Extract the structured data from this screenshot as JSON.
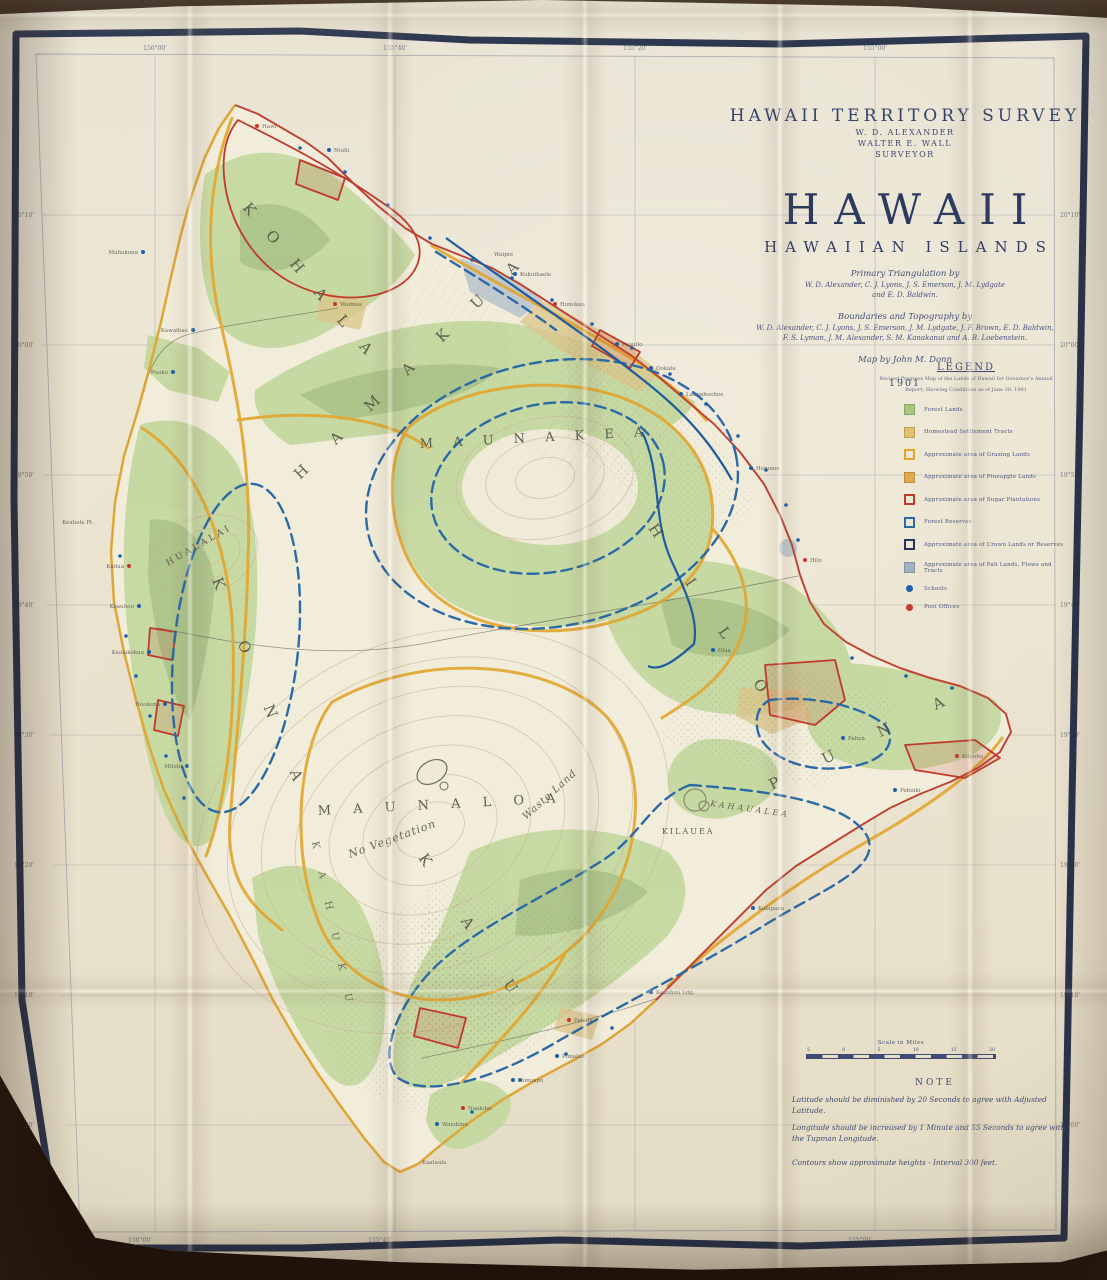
{
  "header": {
    "survey_title": "HAWAII TERRITORY SURVEY",
    "official_1": "W. D. ALEXANDER",
    "official_2": "WALTER E. WALL",
    "official_3": "SURVEYOR",
    "main_title": "HAWAII",
    "subtitle": "HAWAIIAN ISLANDS",
    "credit_1": "Primary Triangulation by",
    "credit_1a": "W. D. Alexander, C. J. Lyons, J. S. Emerson, J. M. Lydgate",
    "credit_1b": "and E. D. Baldwin.",
    "credit_2": "Boundaries and Topography by",
    "credit_2a": "W. D. Alexander, C. J. Lyons, J. S. Emerson, J. M. Lydgate, J. F. Brown, E. D. Baldwin,",
    "credit_2b": "F. S. Lyman, J. M. Alexander, S. M. Kanakanui and A. B. Loebenstein.",
    "credit_3": "Map by John M. Donn",
    "year": "1901"
  },
  "legend": {
    "heading": "LEGEND",
    "note_line1": "Revised Progress Map of the Lands of Hawaii for Governor's Annual",
    "note_line2": "Report, Showing Conditions as of June 30, 1901",
    "items": [
      {
        "label": "Forest Lands",
        "swatch": "fill",
        "color": "#a9c77d"
      },
      {
        "label": "Homestead Settlement Tracts",
        "swatch": "fill",
        "color": "#e3c06b"
      },
      {
        "label": "Approximate area of Grazing Lands",
        "swatch": "outline",
        "color": "#e2a52e"
      },
      {
        "label": "Approximate area of Pineapple Lands",
        "swatch": "fill",
        "color": "#e0aa4f"
      },
      {
        "label": "Approximate area of Sugar Plantations",
        "swatch": "outline",
        "color": "#c03a2b"
      },
      {
        "label": "Forest Reserves",
        "swatch": "outline",
        "color": "#2b6aa6"
      },
      {
        "label": "Approximate area of Crown Lands or Reserves",
        "swatch": "outline",
        "color": "#27355c"
      },
      {
        "label": "Approximate area of Pali Lands, Flows and Tracts",
        "swatch": "fill",
        "color": "#9fb3c4"
      },
      {
        "label": "Schools",
        "swatch": "dot",
        "color": "#1d5fa8"
      },
      {
        "label": "Post Offices",
        "swatch": "dot",
        "color": "#c0392b"
      }
    ]
  },
  "scale": {
    "label": "Scale in Miles",
    "ticks": [
      "5",
      "0",
      "5",
      "10",
      "15",
      "20"
    ]
  },
  "note": {
    "heading": "NOTE",
    "line1": "Latitude should be diminished by 20 Seconds to agree with Adjusted Latitude.",
    "line2": "Longitude should be increased by 1 Minute and 55 Seconds to agree with the Tupman Longitude.",
    "contour_line": "Contours show approximate heights - Interval 300 feet."
  },
  "imprint": "Photo Lith.",
  "map": {
    "labels": [
      {
        "kind": "district",
        "text": "K O H A L A",
        "x": 242,
        "y": 208,
        "rot": 50,
        "ls": 10,
        "size": 15
      },
      {
        "kind": "district",
        "text": "H A M A K U A",
        "x": 300,
        "y": 480,
        "rot": -44,
        "ls": 16,
        "size": 15
      },
      {
        "kind": "district",
        "text": "H I L O",
        "x": 648,
        "y": 528,
        "rot": 56,
        "ls": 24,
        "size": 15
      },
      {
        "kind": "district",
        "text": "K O N A",
        "x": 212,
        "y": 580,
        "rot": 68,
        "ls": 26,
        "size": 15
      },
      {
        "kind": "district",
        "text": "K A U",
        "x": 418,
        "y": 858,
        "rot": 56,
        "ls": 30,
        "size": 15
      },
      {
        "kind": "district",
        "text": "P U N A",
        "x": 772,
        "y": 790,
        "rot": -26,
        "ls": 22,
        "size": 15
      },
      {
        "kind": "district2",
        "text": "K A H U K U",
        "x": 312,
        "y": 842,
        "rot": 78,
        "ls": 10,
        "size": 10
      },
      {
        "kind": "mountain",
        "text": "M A U N A    K E A",
        "x": 420,
        "y": 448,
        "rot": -3,
        "ls": 8,
        "size": 13
      },
      {
        "kind": "mountain",
        "text": "M A U N A    L O A",
        "x": 318,
        "y": 815,
        "rot": -3,
        "ls": 9,
        "size": 13
      },
      {
        "kind": "mountain",
        "text": "HUALALAI",
        "x": 168,
        "y": 566,
        "rot": -30,
        "ls": 3,
        "size": 9
      },
      {
        "kind": "mountain",
        "text": "KILAUEA",
        "x": 662,
        "y": 834,
        "rot": 0,
        "ls": 2,
        "size": 8
      },
      {
        "kind": "annotation",
        "text": "No Vegetation",
        "x": 350,
        "y": 858,
        "rot": -20,
        "ls": 1,
        "size": 11
      },
      {
        "kind": "annotation",
        "text": "Waste Land",
        "x": 526,
        "y": 820,
        "rot": -42,
        "ls": 1,
        "size": 10
      },
      {
        "kind": "annotation",
        "text": "KAHAUALEA",
        "x": 710,
        "y": 806,
        "rot": 8,
        "ls": 3,
        "size": 8
      }
    ],
    "places": [
      {
        "name": "Hawi",
        "x": 262,
        "y": 128,
        "dot": "r"
      },
      {
        "name": "Niulii",
        "x": 334,
        "y": 152,
        "dot": "b"
      },
      {
        "name": "Mahukona",
        "x": 138,
        "y": 254,
        "a": "end",
        "dot": "b"
      },
      {
        "name": "Kawaihae",
        "x": 188,
        "y": 332,
        "a": "end",
        "dot": "b"
      },
      {
        "name": "Puako",
        "x": 168,
        "y": 374,
        "a": "end",
        "dot": "b"
      },
      {
        "name": "Waimea",
        "x": 340,
        "y": 306,
        "dot": "r"
      },
      {
        "name": "Waipio",
        "x": 494,
        "y": 256
      },
      {
        "name": "Kukuihaele",
        "x": 520,
        "y": 276,
        "dot": "b"
      },
      {
        "name": "Honokaa",
        "x": 560,
        "y": 306,
        "dot": "r"
      },
      {
        "name": "Paauilo",
        "x": 622,
        "y": 346,
        "dot": "b"
      },
      {
        "name": "Ookala",
        "x": 656,
        "y": 370,
        "dot": "b"
      },
      {
        "name": "Laupahoehoe",
        "x": 686,
        "y": 396,
        "dot": "b"
      },
      {
        "name": "Honomu",
        "x": 756,
        "y": 470,
        "dot": "b"
      },
      {
        "name": "Hilo",
        "x": 810,
        "y": 562,
        "dot": "r"
      },
      {
        "name": "Olaa",
        "x": 718,
        "y": 652,
        "dot": "b"
      },
      {
        "name": "Pahoa",
        "x": 848,
        "y": 740,
        "dot": "b"
      },
      {
        "name": "Kapoho",
        "x": 962,
        "y": 758,
        "dot": "r"
      },
      {
        "name": "Pohoiki",
        "x": 900,
        "y": 792,
        "dot": "b"
      },
      {
        "name": "Kalapana",
        "x": 758,
        "y": 910,
        "dot": "b"
      },
      {
        "name": "Keauhou Ldg.",
        "x": 656,
        "y": 994,
        "dot": "b"
      },
      {
        "name": "Pahala",
        "x": 574,
        "y": 1022,
        "dot": "r"
      },
      {
        "name": "Punaluu",
        "x": 562,
        "y": 1058,
        "dot": "b"
      },
      {
        "name": "Honuapo",
        "x": 518,
        "y": 1082,
        "dot": "b"
      },
      {
        "name": "Naalehu",
        "x": 468,
        "y": 1110,
        "dot": "r"
      },
      {
        "name": "Waiohinu",
        "x": 442,
        "y": 1126,
        "dot": "b"
      },
      {
        "name": "Kaalualu",
        "x": 422,
        "y": 1164
      },
      {
        "name": "Milolii",
        "x": 182,
        "y": 768,
        "a": "end",
        "dot": "b"
      },
      {
        "name": "Hookena",
        "x": 160,
        "y": 706,
        "a": "end",
        "dot": "b"
      },
      {
        "name": "Kealakekua",
        "x": 144,
        "y": 654,
        "a": "end",
        "dot": "b"
      },
      {
        "name": "Keauhou",
        "x": 134,
        "y": 608,
        "a": "end",
        "dot": "b"
      },
      {
        "name": "Kailua",
        "x": 124,
        "y": 568,
        "a": "end",
        "dot": "r"
      },
      {
        "name": "Keahole Pt.",
        "x": 94,
        "y": 524,
        "a": "end"
      }
    ],
    "coast_dots": [
      {
        "x": 300,
        "y": 148
      },
      {
        "x": 345,
        "y": 172
      },
      {
        "x": 388,
        "y": 205
      },
      {
        "x": 430,
        "y": 238
      },
      {
        "x": 472,
        "y": 260
      },
      {
        "x": 512,
        "y": 278
      },
      {
        "x": 552,
        "y": 300
      },
      {
        "x": 592,
        "y": 324
      },
      {
        "x": 632,
        "y": 348
      },
      {
        "x": 670,
        "y": 374
      },
      {
        "x": 706,
        "y": 404
      },
      {
        "x": 738,
        "y": 436
      },
      {
        "x": 766,
        "y": 470
      },
      {
        "x": 786,
        "y": 505
      },
      {
        "x": 798,
        "y": 540
      },
      {
        "x": 852,
        "y": 658
      },
      {
        "x": 906,
        "y": 676
      },
      {
        "x": 952,
        "y": 688
      },
      {
        "x": 120,
        "y": 556
      },
      {
        "x": 126,
        "y": 636
      },
      {
        "x": 136,
        "y": 676
      },
      {
        "x": 150,
        "y": 716
      },
      {
        "x": 166,
        "y": 756
      },
      {
        "x": 184,
        "y": 798
      },
      {
        "x": 612,
        "y": 1028
      },
      {
        "x": 566,
        "y": 1054
      },
      {
        "x": 520,
        "y": 1080
      },
      {
        "x": 472,
        "y": 1112
      }
    ],
    "graticule": {
      "lon": [
        {
          "text": "156°00'",
          "x": 155
        },
        {
          "text": "155°40'",
          "x": 395
        },
        {
          "text": "155°20'",
          "x": 635
        },
        {
          "text": "155°00'",
          "x": 875
        }
      ],
      "lat": [
        {
          "text": "20°10'",
          "y": 215
        },
        {
          "text": "20°00'",
          "y": 345
        },
        {
          "text": "19°50'",
          "y": 475
        },
        {
          "text": "19°40'",
          "y": 605
        },
        {
          "text": "19°30'",
          "y": 735
        },
        {
          "text": "19°20'",
          "y": 865
        },
        {
          "text": "19°10'",
          "y": 995
        },
        {
          "text": "19°00'",
          "y": 1125
        }
      ]
    }
  },
  "colors": {
    "table_brown": "#241609",
    "paper": "#e9e2cf",
    "border_navy": "#1e2946",
    "graticule_gray": "#8e94a3",
    "island_base": "#f2eddb",
    "green_light": "#c2d79c",
    "green_forest": "#8fae6e",
    "homestead_tan": "#dcc489",
    "boundary_yellow": "#e2a52e",
    "boundary_red": "#c03a2b",
    "reserve_blue_dashed": "#2b6aa6",
    "boundary_blue_solid": "#1f5c9e",
    "contour": "#c9b18f",
    "pali_bluegray": "#9fb3c4",
    "school_dot_blue": "#1d5fa8",
    "post_office_dot_red": "#c0392b",
    "ink_blue": "#36426b"
  }
}
